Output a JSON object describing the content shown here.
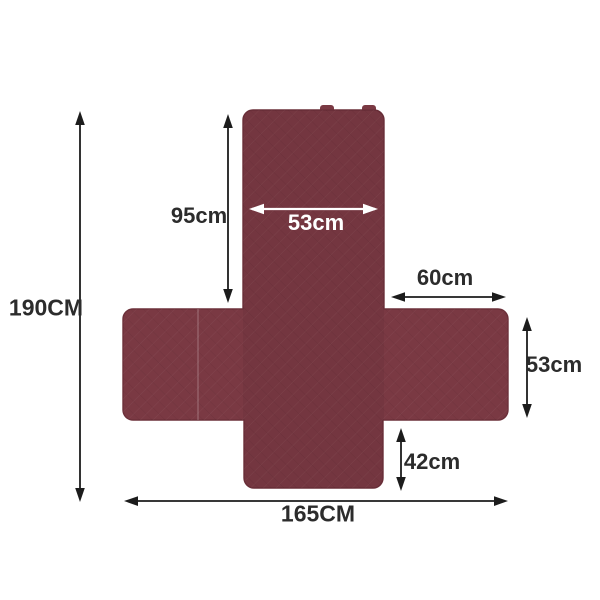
{
  "figure": {
    "background_color": "#ffffff",
    "fabric_color": "#7a3943",
    "fabric_edge_color": "#6c303a",
    "arrow_color": "#1c1c1c",
    "label_color": "#2c2c2c",
    "inner_label_color": "#ffffff"
  },
  "dimensions": {
    "total_height": "190CM",
    "back_height": "95cm",
    "back_width": "53cm",
    "arm_length": "60cm",
    "arm_depth": "53cm",
    "front_skirt_height": "42cm",
    "total_width": "165CM"
  }
}
